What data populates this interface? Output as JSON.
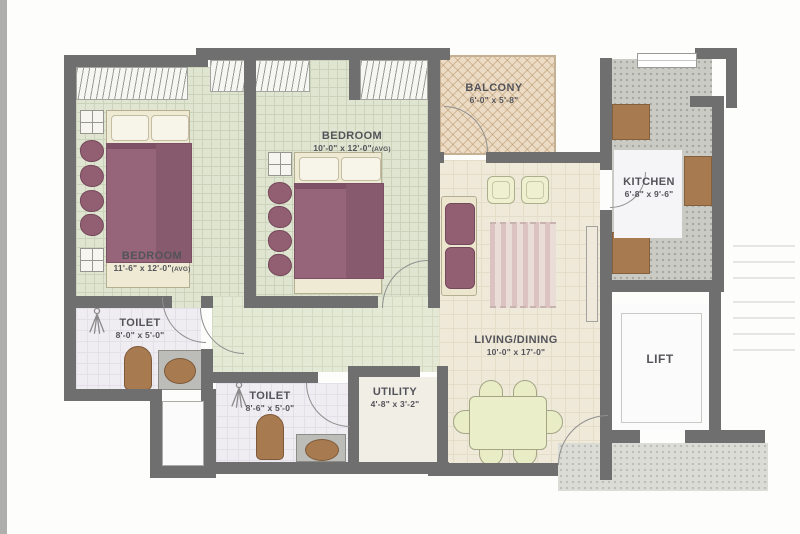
{
  "plan": {
    "rooms": {
      "bedroom_1": {
        "name": "BEDROOM",
        "dims": "11'-6\" x 12'-0\"",
        "avg": "(AVG)"
      },
      "bedroom_2": {
        "name": "BEDROOM",
        "dims": "10'-0\" x 12'-0\"",
        "avg": "(AVG)"
      },
      "balcony": {
        "name": "BALCONY",
        "dims": "6'-0\" x 5'-8\""
      },
      "kitchen": {
        "name": "KITCHEN",
        "dims": "6'-8\" x 9'-6\""
      },
      "living_dining": {
        "name": "LIVING/DINING",
        "dims": "10'-0\" x 17'-0\""
      },
      "toilet_1": {
        "name": "TOILET",
        "dims": "8'-0\" x 5'-0\""
      },
      "toilet_2": {
        "name": "TOILET",
        "dims": "8'-6\" x 5'-0\""
      },
      "utility": {
        "name": "UTILITY",
        "dims": "4'-8\" x 3'-2\""
      },
      "lift": {
        "name": "LIFT"
      }
    },
    "colors": {
      "wall": "#6f6f6f",
      "bedroom_floor": "#dfe5d0",
      "living_floor": "#efe9da",
      "balcony_floor": "#ecdcc5",
      "kitchen_floor": "#cbcbc6",
      "toilet_floor": "#efecf2",
      "furniture_maroon": "#925f72",
      "counter_brown": "#a87a50",
      "dining_green": "#eaeec9"
    }
  }
}
